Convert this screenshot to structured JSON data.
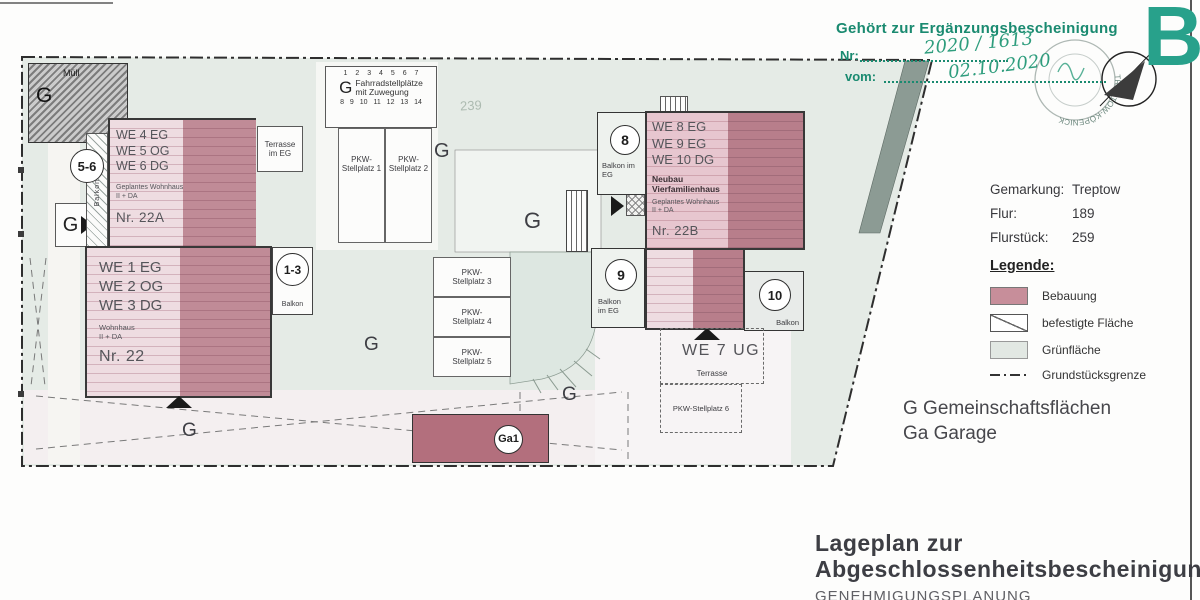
{
  "colors": {
    "accent_green": "#1a8a70",
    "handwriting_green": "#2e9d7d",
    "big_letter_teal": "#28a18b",
    "bebauung_light": "#ecd7dd",
    "bebauung_dark": "#b5717f",
    "gruenflaeche": "#e5ebe6"
  },
  "stamp_header": {
    "title": "Gehört zur Ergänzungsbescheinigung",
    "nr_label": "Nr:",
    "nr_value": "2020 / 1613",
    "vom_label": "vom:",
    "vom_value": "02.10.2020",
    "round_stamp_text": "TREPTOW-KÖPENICK",
    "big_letter": "B"
  },
  "parcel_info": {
    "rows": [
      {
        "label": "Gemarkung:",
        "value": "Treptow"
      },
      {
        "label": "Flur:",
        "value": "189"
      },
      {
        "label": "Flurstück:",
        "value": "259"
      }
    ]
  },
  "legend": {
    "title": "Legende:",
    "items": [
      {
        "label": "Bebauung"
      },
      {
        "label": "befestigte Fläche"
      },
      {
        "label": "Grünfläche"
      },
      {
        "label": "Grundstücksgrenze"
      }
    ]
  },
  "abbreviations": {
    "g_line": "G Gemeinschaftsflächen",
    "ga_line": "Ga Garage"
  },
  "title_block": {
    "line1": "Lageplan zur",
    "line2": "Abgeschlossenheitsbescheinigung",
    "subtitle": "GENEHMIGUNGSPLANUNG"
  },
  "plan": {
    "g": "G",
    "parcel_faint": "239",
    "muell_label": "Müll",
    "bike": {
      "row_top": "1 2 3 4 5 6 7",
      "row_bottom": "8 9 10 11 12 13 14",
      "line1": "Fahrradstellplätze",
      "line2": "mit Zuwegung"
    },
    "bldg_22a": {
      "we": "WE 4 EG\nWE 5 OG\nWE 6 DG",
      "sub": "Geplantes Wohnhaus\nII + DA",
      "nr": "Nr. 22A"
    },
    "bldg_22": {
      "we": "WE 1 EG\nWE 2 OG\nWE 3 DG",
      "sub": "Wohnhaus\nII + DA",
      "nr": "Nr. 22"
    },
    "bldg_22b": {
      "we": "WE 8 EG\nWE 9 EG\nWE 10 DG",
      "bold": "Neubau\nVierfamilienhaus",
      "sub": "Geplantes Wohnhaus\nII + DA",
      "nr": "Nr. 22B"
    },
    "terrasse_eg": "Terrasse\nim EG",
    "balkon": "Balkon",
    "balkon_im_eg": "Balkon im\nEG",
    "balkon_im_eg2": "Balkon\nim EG",
    "badge_56": "5-6",
    "badge_13": "1-3",
    "badge_8": "8",
    "badge_9": "9",
    "badge_10": "10",
    "badge_ga1": "Ga1",
    "we7": "WE 7 UG",
    "terrasse": "Terrasse",
    "pkw": [
      "PKW-\nStellplatz 1",
      "PKW-\nStellplatz 2",
      "PKW-\nStellplatz 3",
      "PKW-\nStellplatz 4",
      "PKW-\nStellplatz 5"
    ],
    "pkw6": "PKW-Stellplatz 6"
  }
}
